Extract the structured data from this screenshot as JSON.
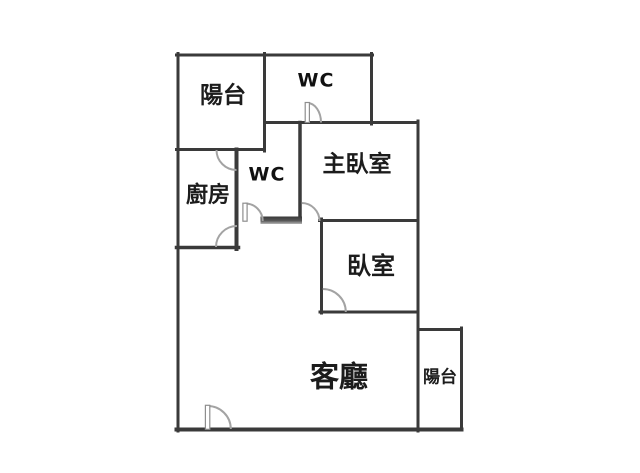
{
  "colors": {
    "background": "#ffffff",
    "wall": "#3a3a3a",
    "door_arc": "#a3a3a3",
    "text": "#1c1c1c"
  },
  "rooms": [
    {
      "id": "balcony-top",
      "label": "陽台"
    },
    {
      "id": "toilet-top",
      "label": "WC"
    },
    {
      "id": "kitchen",
      "label": "廚房"
    },
    {
      "id": "toilet-inner",
      "label": "WC"
    },
    {
      "id": "master-bedroom",
      "label": "主臥室"
    },
    {
      "id": "bedroom",
      "label": "臥室"
    },
    {
      "id": "living-room",
      "label": "客廳"
    },
    {
      "id": "balcony-right",
      "label": "陽台"
    }
  ]
}
